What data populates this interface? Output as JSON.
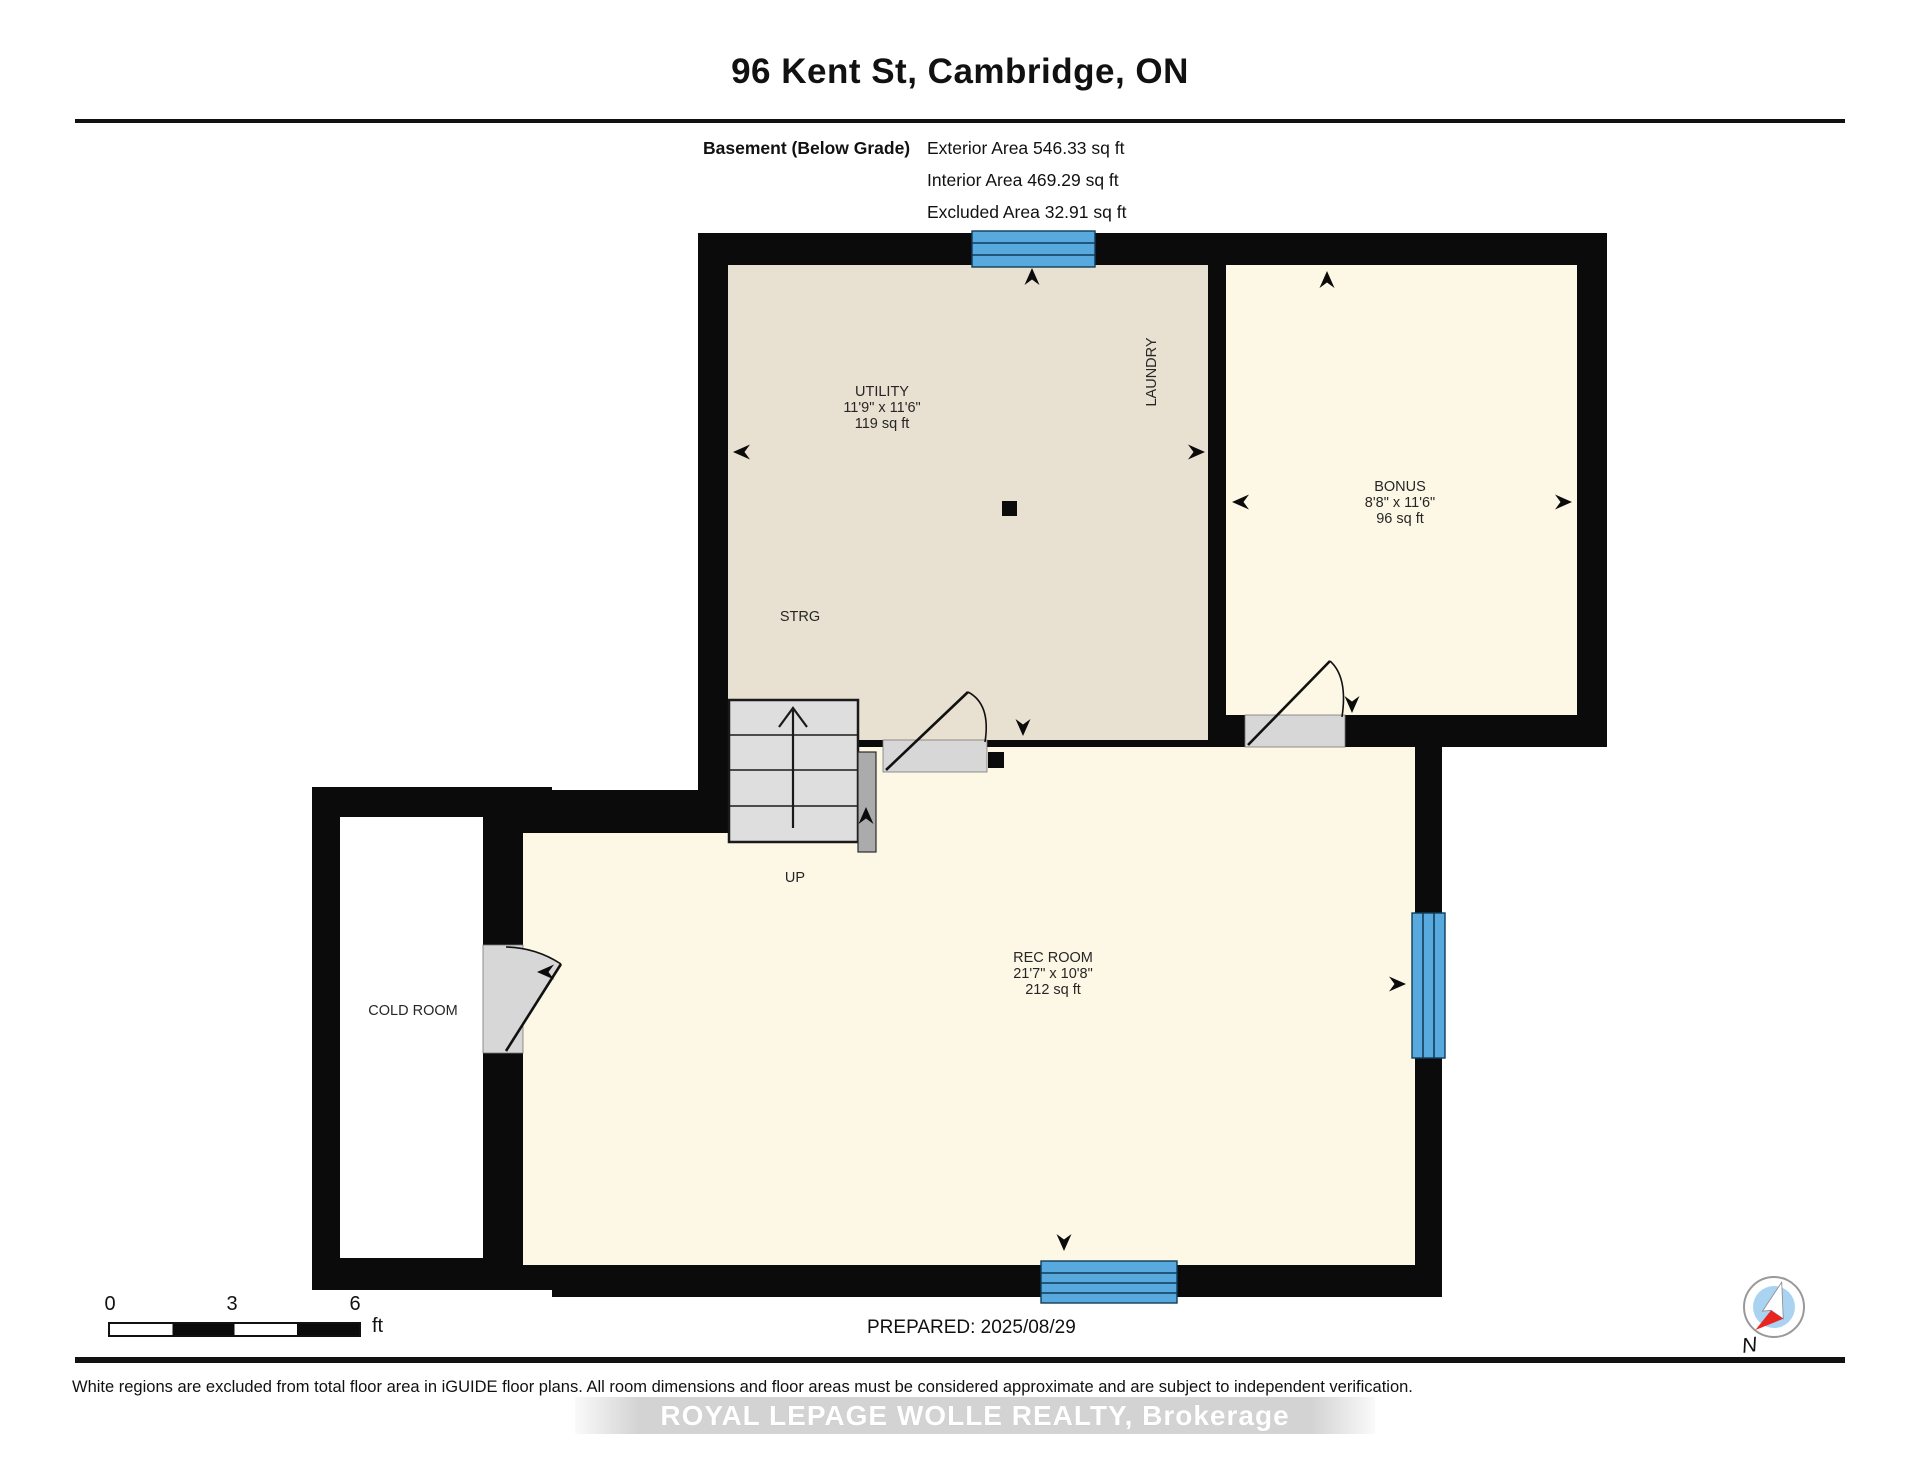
{
  "header": {
    "title": "96 Kent St, Cambridge, ON",
    "floor_label": "Basement (Below Grade)",
    "area_lines": {
      "exterior": "Exterior Area 546.33 sq ft",
      "interior": "Interior Area 469.29 sq ft",
      "excluded": "Excluded Area 32.91 sq ft"
    }
  },
  "rooms": {
    "utility": {
      "name": "UTILITY",
      "dims": "11'9\" x 11'6\"",
      "area": "119 sq ft"
    },
    "laundry": {
      "name": "LAUNDRY"
    },
    "bonus": {
      "name": "BONUS",
      "dims": "8'8\" x 11'6\"",
      "area": "96 sq ft"
    },
    "strg": {
      "name": "STRG"
    },
    "stairs": {
      "direction_label": "UP"
    },
    "rec_room": {
      "name": "REC ROOM",
      "dims": "21'7\" x 10'8\"",
      "area": "212 sq ft"
    },
    "cold_room": {
      "name": "COLD ROOM"
    }
  },
  "scale_bar": {
    "tick_0": "0",
    "tick_3": "3",
    "tick_6": "6",
    "unit": "ft"
  },
  "compass": {
    "label": "N"
  },
  "footer": {
    "prepared": "PREPARED: 2025/08/29",
    "disclaimer": "White regions are excluded from total floor area in iGUIDE floor plans. All room dimensions and floor areas must be considered approximate and are subject to independent verification.",
    "watermark": "ROYAL LEPAGE WOLLE REALTY, Brokerage"
  },
  "colors": {
    "wall": "#0b0b0b",
    "utility_fill": "#e8e0d0",
    "cream_fill": "#fdf8e5",
    "cold_fill": "#ffffff",
    "window_blue": "#57a9de",
    "window_line": "#123c59",
    "stairs_fill": "#dedede",
    "door_gray": "#d7d7d7",
    "railing_gray": "#ababab",
    "compass_red": "#e8251f",
    "compass_blue": "#a9d3f0"
  }
}
